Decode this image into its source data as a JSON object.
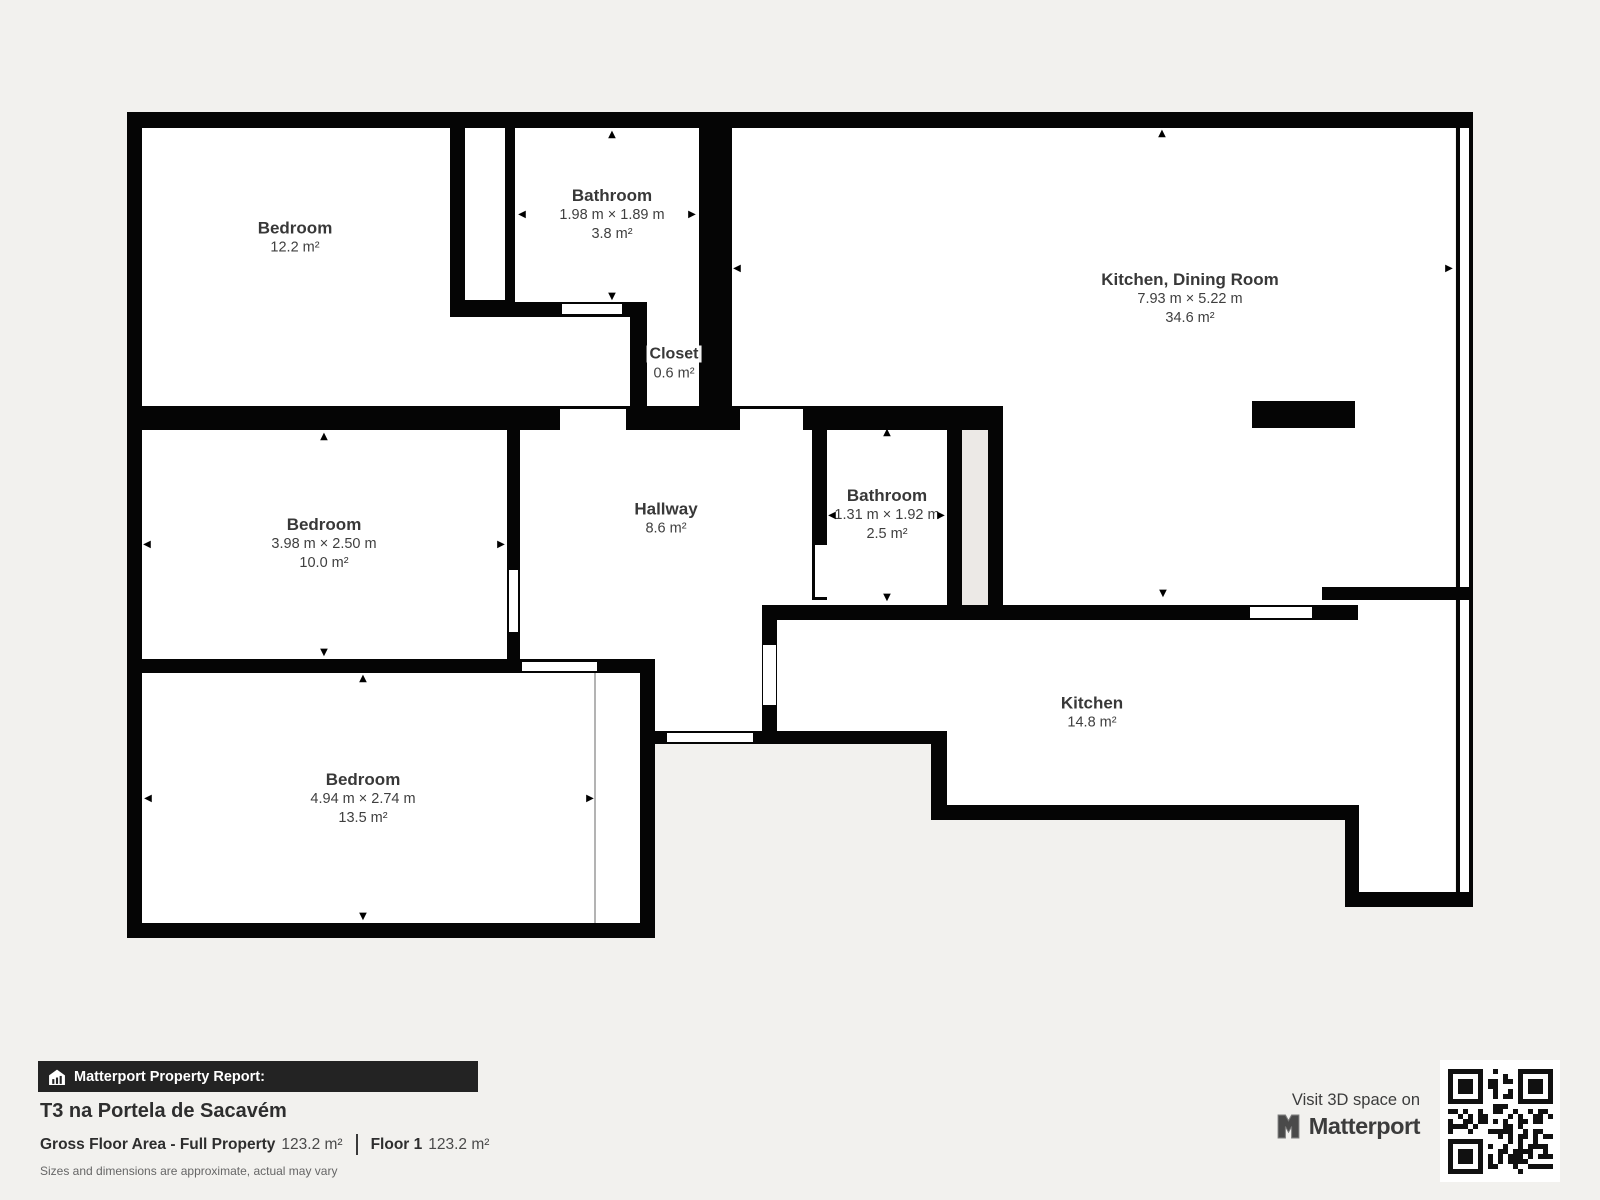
{
  "plan": {
    "rooms": {
      "tl_bedroom": {
        "name": "Bedroom",
        "area": "12.2 m²"
      },
      "bathroom_top": {
        "name": "Bathroom",
        "dims": "1.98 m × 1.89 m",
        "area": "3.8 m²"
      },
      "kitchen_dining": {
        "name": "Kitchen, Dining Room",
        "dims": "7.93 m × 5.22 m",
        "area": "34.6 m²"
      },
      "closet": {
        "name": "Closet",
        "area": "0.6 m²"
      },
      "mid_bedroom": {
        "name": "Bedroom",
        "dims": "3.98 m × 2.50 m",
        "area": "10.0 m²"
      },
      "hallway": {
        "name": "Hallway",
        "area": "8.6 m²"
      },
      "bathroom_mid": {
        "name": "Bathroom",
        "dims": "1.31 m × 1.92 m",
        "area": "2.5 m²"
      },
      "kitchen": {
        "name": "Kitchen",
        "area": "14.8 m²"
      },
      "bottom_bedroom": {
        "name": "Bedroom",
        "dims": "4.94 m × 2.74 m",
        "area": "13.5 m²"
      }
    },
    "colors": {
      "wall": "#050505",
      "floor": "#ffffff",
      "background": "#f2f1ee",
      "shaft": "#ece9e6"
    }
  },
  "icons": {
    "arrow_up": "▲",
    "arrow_down": "▼",
    "arrow_left": "◀",
    "arrow_right": "▶",
    "banner_house": "house-bar-chart-icon",
    "brand_mark": "matterport-m-icon",
    "qr": "qr-code"
  },
  "footer": {
    "banner_label": "Matterport Property Report:",
    "property_title": "T3 na Portela de Sacavém",
    "gfa_label": "Gross Floor Area - Full Property",
    "gfa_value": "123.2 m²",
    "floor_label": "Floor 1",
    "floor_value": "123.2 m²",
    "disclaimer": "Sizes and dimensions are approximate, actual may vary",
    "visit_label": "Visit 3D space on",
    "brand": "Matterport"
  }
}
